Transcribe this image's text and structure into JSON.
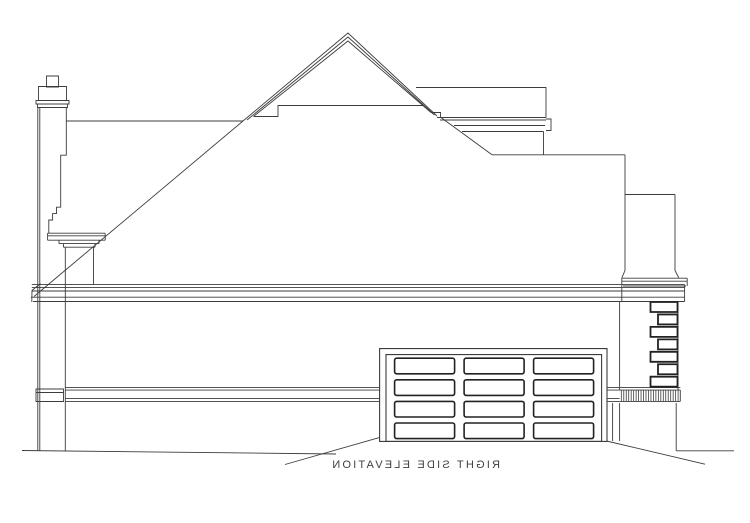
{
  "document": {
    "caption": "RIGHT SIDE ELEVATION",
    "caption_is_mirrored": true,
    "drawing_type": "architectural elevation drawing",
    "view": "right side"
  },
  "colors": {
    "background": "#ffffff",
    "line": "#3c3c3c",
    "line_bold": "#222222",
    "text": "#3f3f3f"
  },
  "features": {
    "chimney": "corbelled masonry chimney with cap at left edge",
    "main_roof": "front-facing gable with triple rake trim over hip roof",
    "ridge": "horizontal main ridge line behind gable",
    "rear_block": "rear upper-story wall block with frieze bands",
    "right_wing": "stepped rear wing walls over garage",
    "eave": "boxed eave cornice band across full elevation",
    "left_cornice": "small cornice return below chimney",
    "quoins": "alternating corner quoin blocks at right rear corner",
    "brick_band": "hatched soldier-course brick belt below quoins",
    "belt_course": "horizontal belt-course trim band at floor line",
    "garage_door": "raised-panel overhead garage door",
    "grade": "grade lines with sloped driveway at garage"
  },
  "garage_door": {
    "columns": 3,
    "rows": 4
  },
  "quoins": {
    "count": 7
  },
  "brick_band": {
    "tick_count": 24
  }
}
